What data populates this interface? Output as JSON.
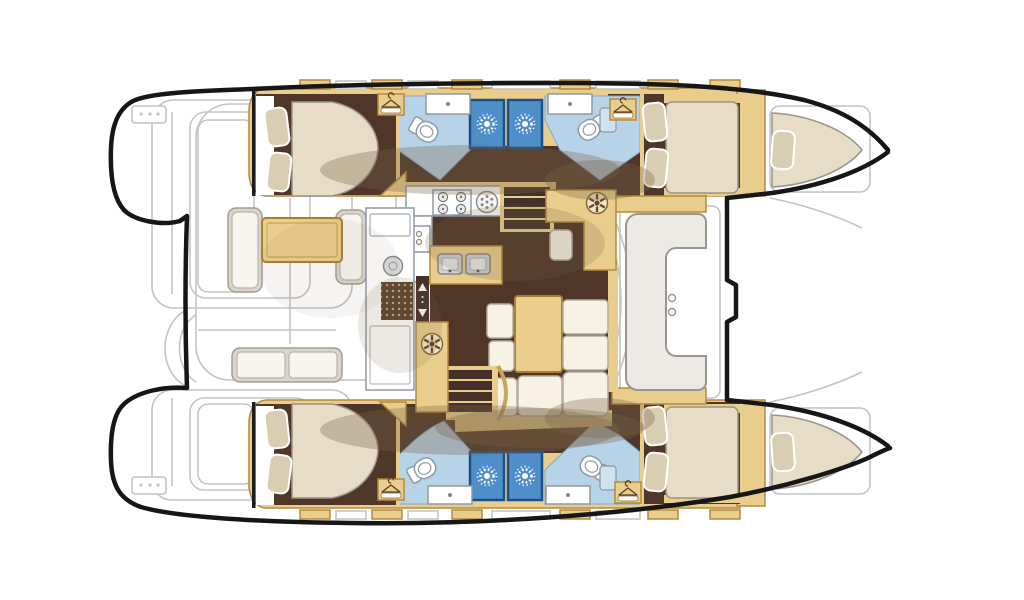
{
  "figure": {
    "type": "boat-floorplan",
    "subject": "catamaran deck and accommodation plan, top view",
    "orientation": "bows-right",
    "visible_counts": {
      "double-berth-cabins": 4,
      "forepeak-berths": 2,
      "toilets": 4,
      "shower-stalls": 4,
      "stove-burners": 4,
      "cockpit-tables": 1,
      "salon-tables": 1
    }
  },
  "areas": [
    "aft-cockpit",
    "port-transom-steps",
    "starboard-transom-steps",
    "salon",
    "galley",
    "nav-station",
    "forward-cockpit",
    "port-aft-cabin",
    "port-forward-cabin",
    "starboard-aft-cabin",
    "starboard-forward-cabin",
    "port-head",
    "port-forward-head",
    "starboard-head",
    "starboard-forward-head",
    "port-forepeak-berth",
    "starboard-forepeak-berth",
    "trampoline-area"
  ],
  "icons": {
    "shower-sun-icon": "white radial sunburst on blue shower stall",
    "wardrobe-hanger-icon": "clothes hanger in tan locker box",
    "stove-burner-icon": "four-ring hob",
    "round-sink-icon": "circular basin with drain dots",
    "double-sink-icon": "twin square basins with faucets",
    "appliance-dial-icon": "round spoked dial hatch",
    "door-arrows-icon": "up/down arrows on sliding door track",
    "teak-grate-icon": "dotted teak shower grating",
    "cockpit-grill-icon": "round grill plate"
  },
  "palette": {
    "hullOutline": "#161616",
    "deckWhite": "#ffffff",
    "linework": "#c4c4c4",
    "joineryTan": "#e9cd8c",
    "joineryEdge": "#b5893c",
    "floorBrown": "#4f3629",
    "stairDark": "#46312a",
    "mattress": "#e7ddc6",
    "mattressShade": "#cabb9b",
    "pillow": "#d9cdb2",
    "headFloorBlue": "#b7d3e8",
    "showerBlue": "#4e8fc9",
    "showerEdge": "#1e4f86",
    "fixtureWhite": "#ffffff",
    "fixtureStroke": "#8d9aa6",
    "sofaCream": "#f6f2e4",
    "tableTan": "#e9ce8d",
    "cockpitGray": "#d9d4cc",
    "cushionWhite": "#f7f5f0",
    "grateBrown": "#5a4330",
    "grateDot": "#c9a876",
    "shadowOlive": "rgba(122,100,72,0.32)"
  }
}
